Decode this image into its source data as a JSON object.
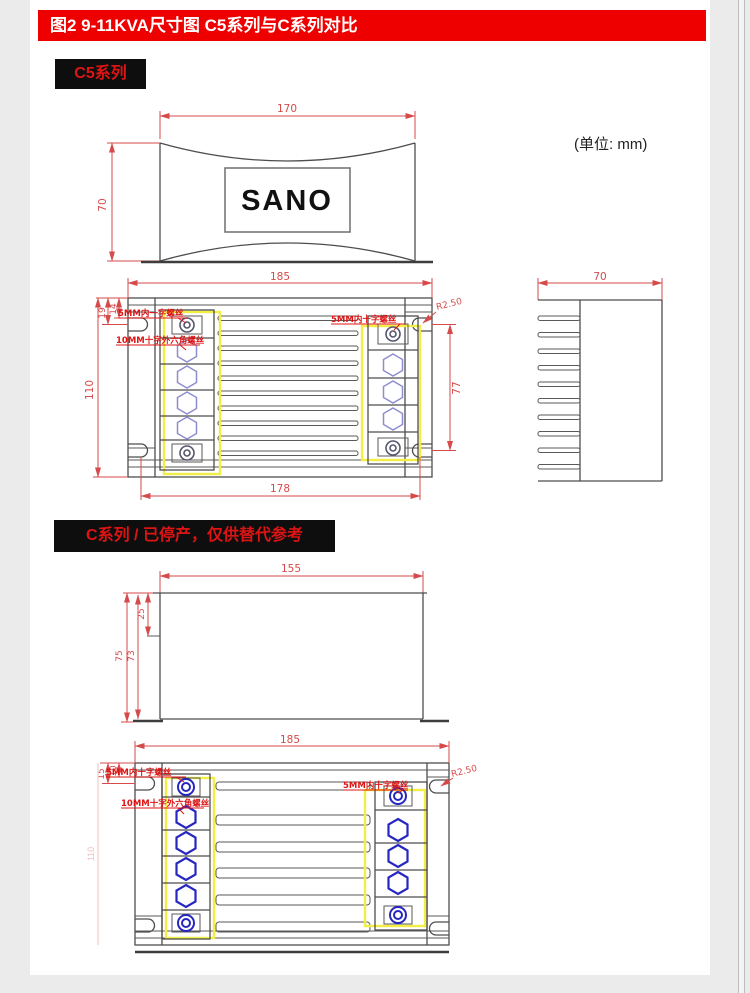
{
  "page": {
    "title_bar": "图2  9-11KVA尺寸图 C5系列与C系列对比",
    "section_c5_label": "C5系列",
    "section_c_label": "C系列 / 已停产，仅供替代参考",
    "unit_note": "(单位:  mm)"
  },
  "c5_top_view": {
    "logo": "SANO",
    "dim_width": "170",
    "dim_height": "70"
  },
  "c5_front_view": {
    "dim_width": "185",
    "dim_mount_width": "178",
    "dim_height": "110",
    "dim_terminal_span": "77",
    "dim_edge_a": "19",
    "dim_edge_b": "14",
    "dim_radius": "R2.50",
    "label_slot_screw": "5MM内一字螺丝",
    "label_hex_screw": "10MM十字外六角螺丝",
    "label_cross_screw": "5MM内十字螺丝"
  },
  "c5_side_view": {
    "dim_width": "70"
  },
  "c_side_view": {
    "dim_width": "155",
    "dim_height_outer": "75",
    "dim_height_inner": "73",
    "dim_top_offset": "25"
  },
  "c_front_view": {
    "dim_width": "185",
    "dim_height": "110",
    "dim_edge_a": "15",
    "dim_edge_b": "10",
    "dim_radius": "R2.50",
    "label_cross_screw_left": "5MM内十字螺丝",
    "label_hex_screw": "10MM十字外六角螺丝",
    "label_cross_screw_right": "5MM内十字螺丝"
  },
  "colors": {
    "header_red": "#ef0000",
    "dim_red": "#d54a4a",
    "label_red": "#dd1414",
    "line_dark": "#4d4d4d",
    "highlight_yellow": "#f2ee45",
    "terminal_purple": "#8d8dd0",
    "terminal_blue": "#2626c0"
  }
}
